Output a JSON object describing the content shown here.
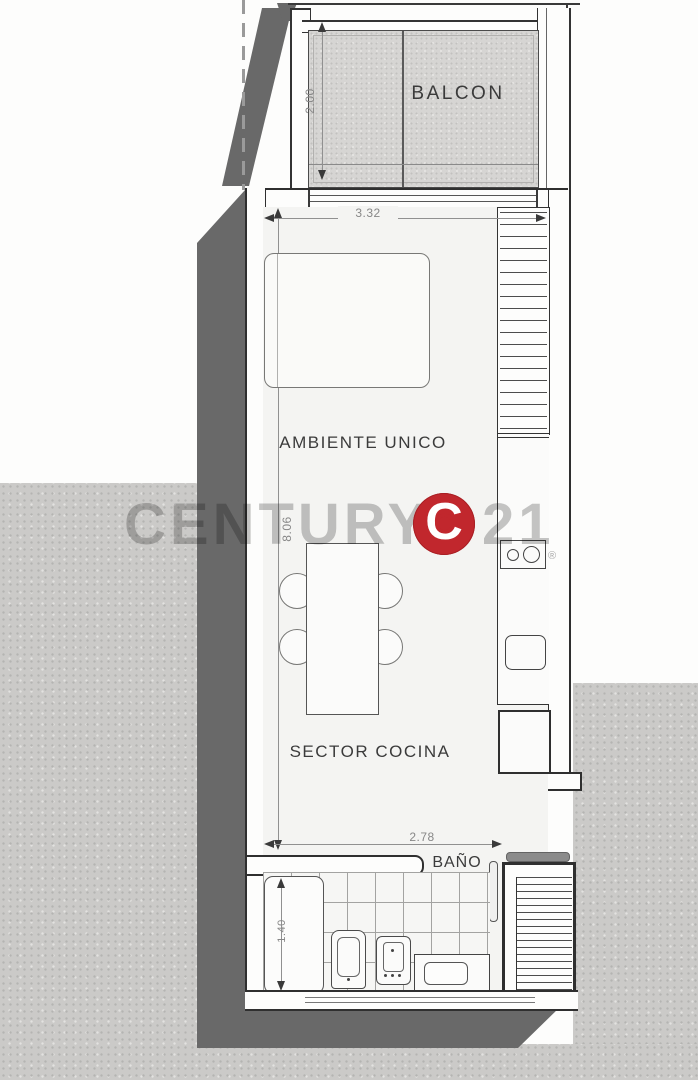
{
  "labels": {
    "balcony": "BALCON",
    "main_room": "AMBIENTE UNICO",
    "kitchen": "SECTOR COCINA",
    "bathroom": "BAÑO"
  },
  "dimensions": {
    "balcony_depth": "2.00",
    "room_width": "3.32",
    "room_length": "8.06",
    "kitchen_width": "2.78",
    "bathroom_width": "1.40"
  },
  "watermark": {
    "brand": "CENTURY",
    "number": "21",
    "registered": "®",
    "logo_letter": "C"
  },
  "colors": {
    "accent_red": "#c1272d",
    "shadow_gray": "#696969",
    "concrete_gray": "#cbcac8",
    "watermark_gray": "#c6c6c6",
    "line_dark": "#3a3a3a"
  }
}
